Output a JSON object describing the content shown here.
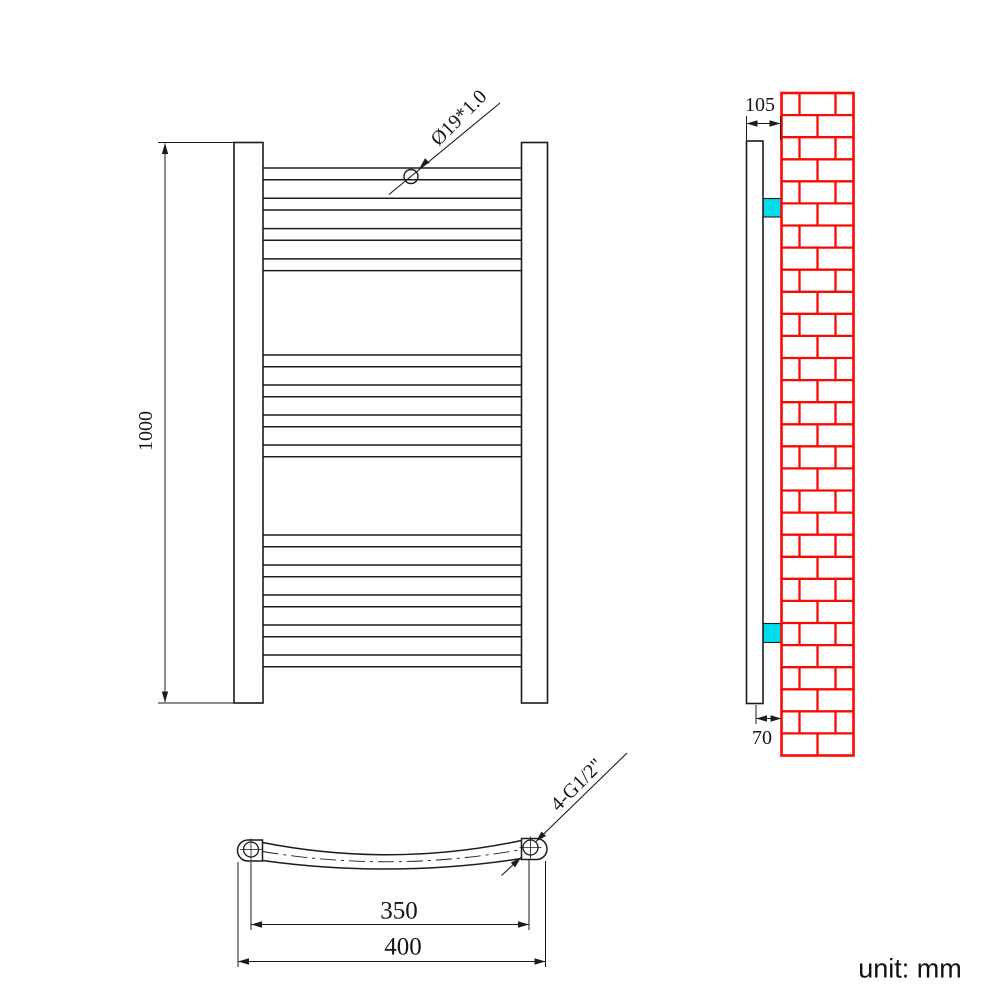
{
  "drawing_title": "Curved heated towel rail technical drawing",
  "unit_note": "unit: mm",
  "colors": {
    "line": "#1c1c1c",
    "wall_red": "#fa0a02",
    "bracket_cyan": "#00dcec",
    "background": "#ffffff"
  },
  "front_view": {
    "height_label": "1000",
    "tube_label": "Ø19*1.0",
    "bar_count": 13,
    "bar_groups": [
      {
        "count": 4,
        "start_y": 168,
        "spacing": 30.3
      },
      {
        "count": 4,
        "start_y": 355,
        "spacing": 30
      },
      {
        "count": 5,
        "start_y": 535,
        "spacing": 30
      }
    ],
    "bar_thickness": 11.7
  },
  "side_view": {
    "depth_label": "105",
    "bracket_label": "70",
    "bracket_count": 2
  },
  "bottom_view": {
    "centres_label": "350",
    "width_label": "400",
    "thread_label": "4-G1/2\""
  }
}
